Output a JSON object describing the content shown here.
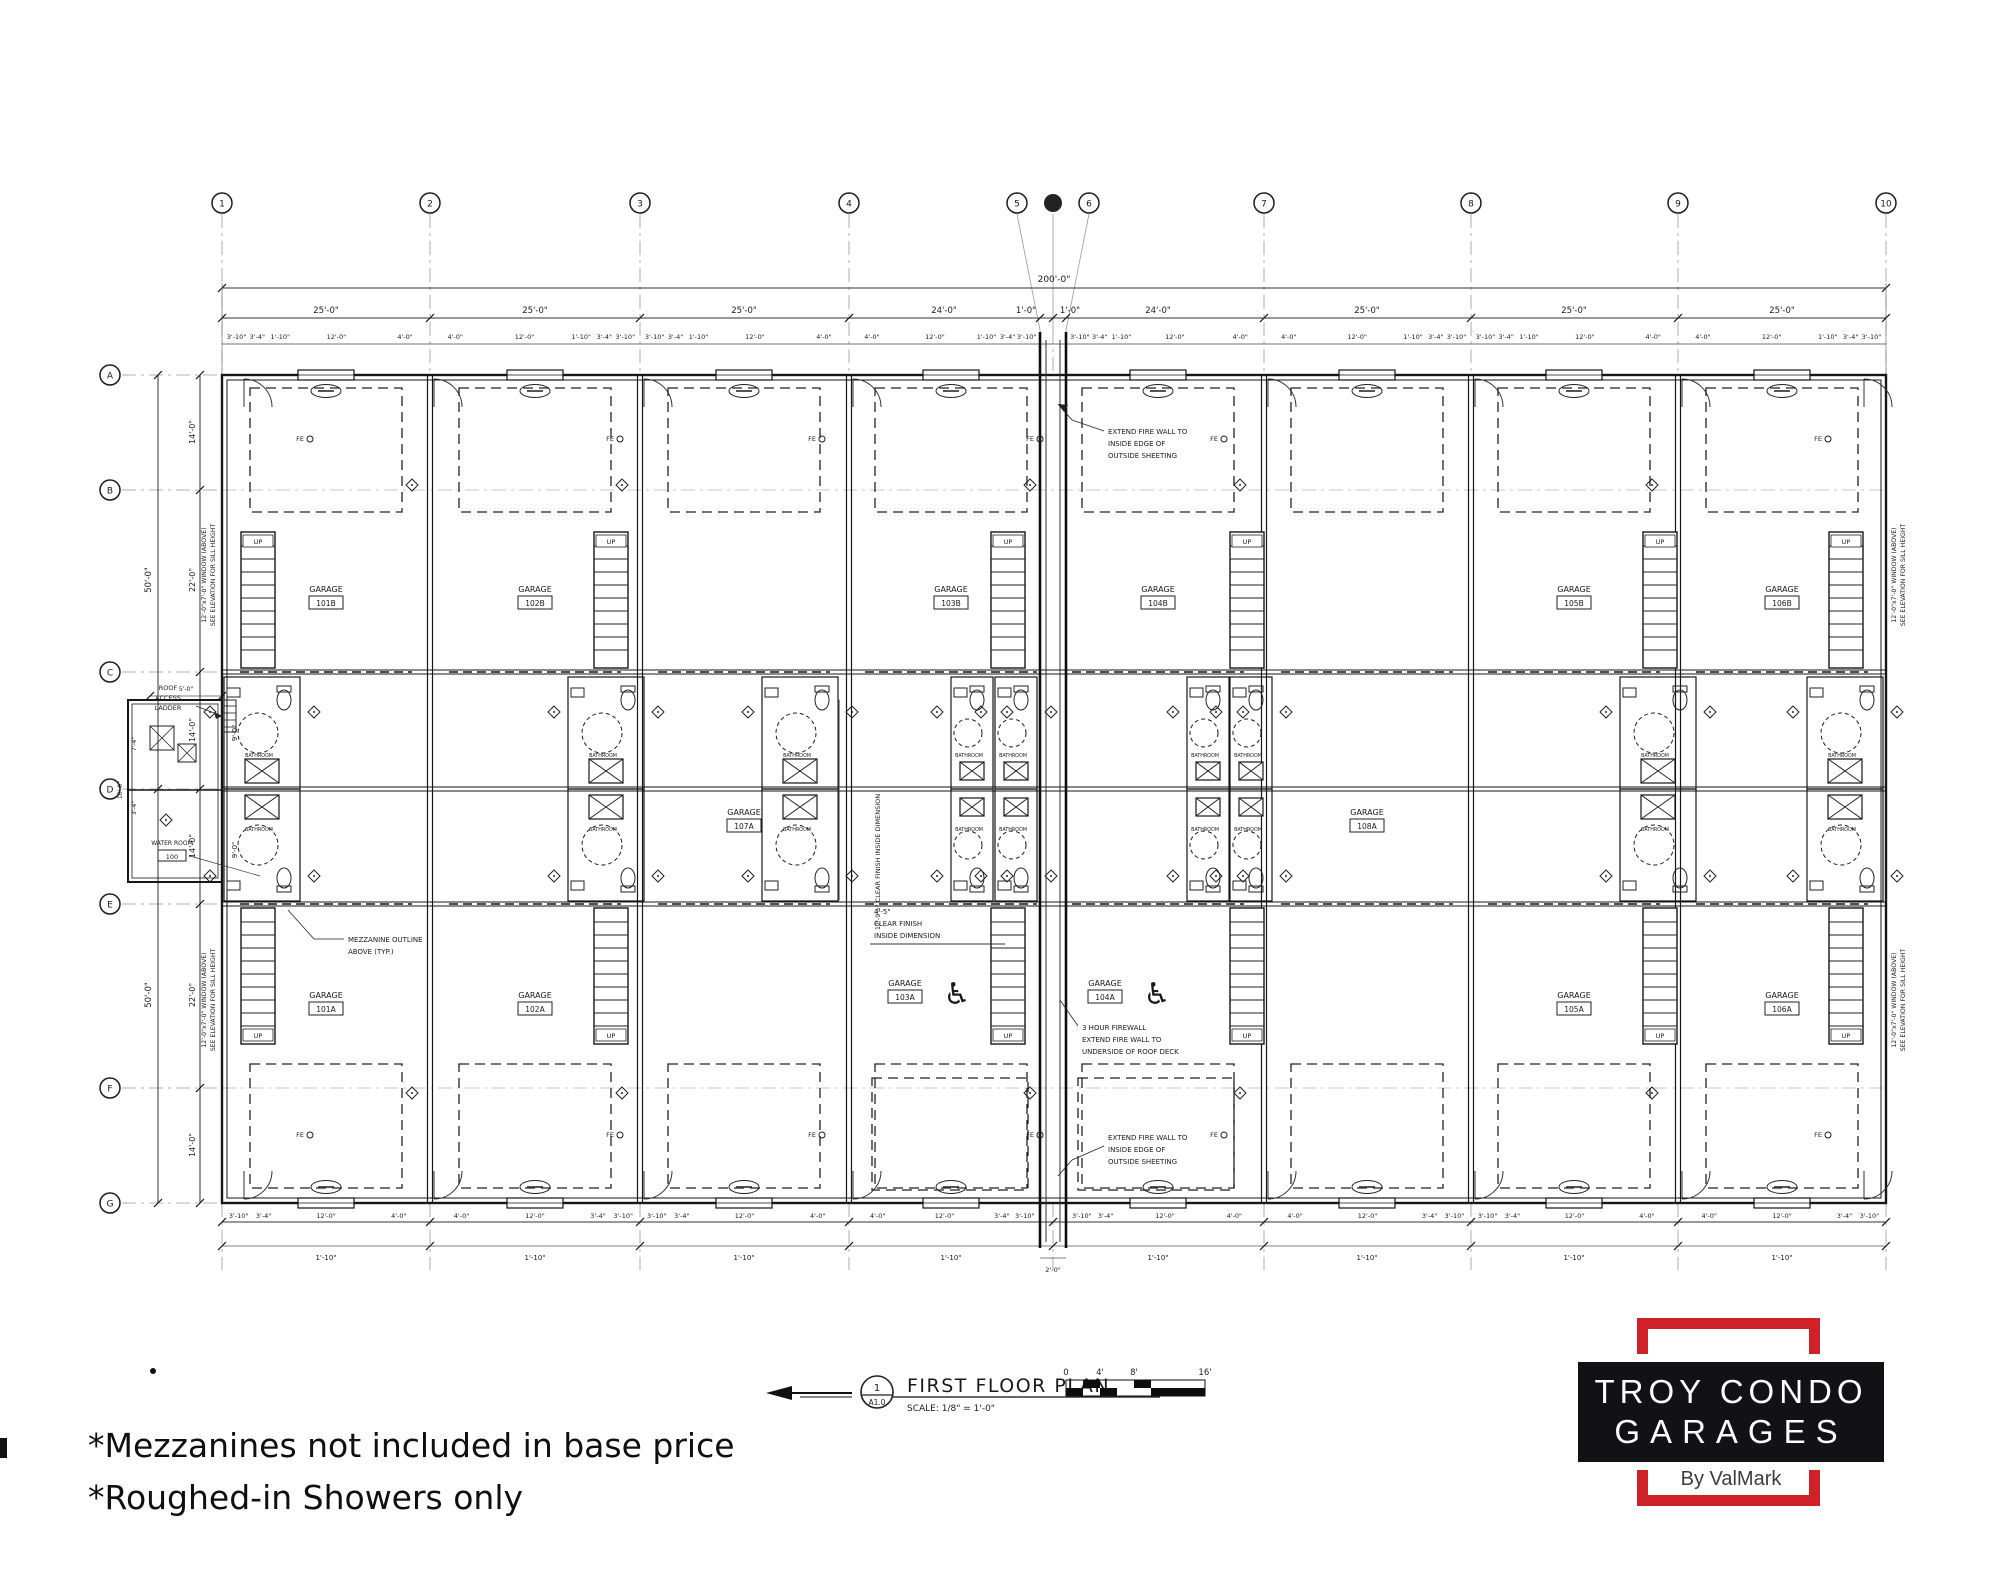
{
  "colors": {
    "line": "#1c1c1c",
    "grid": "#9a9a9a",
    "accent_red": "#d02128",
    "logo_black": "#121216"
  },
  "icons": {
    "wheelchair": "♿"
  },
  "footnotes": {
    "line1": "*Mezzanines not included in base price",
    "line2": "*Roughed-in Showers only"
  },
  "logo": {
    "line1": "TROY CONDO",
    "line2": "GARAGES",
    "byline": "By ValMark"
  },
  "titleblock": {
    "detail_number": "1",
    "sheet_ref": "A1.0",
    "title": "FIRST FLOOR PLAN",
    "scale": "SCALE: 1/8\" = 1'-0\"",
    "scale_ticks": [
      "0",
      "4'",
      "8'",
      "16'"
    ]
  },
  "grid": {
    "columns": [
      "1",
      "2",
      "3",
      "4",
      "5",
      "",
      "6",
      "7",
      "8",
      "9",
      "10"
    ],
    "rows": [
      "A",
      "B",
      "C",
      "D",
      "E",
      "F",
      "G"
    ]
  },
  "dims": {
    "overall_width": "200'-0\"",
    "bay_dims": [
      "25'-0\"",
      "25'-0\"",
      "25'-0\"",
      "24'-0\"",
      "1'-0\"",
      "1'-0\"",
      "24'-0\"",
      "25'-0\"",
      "25'-0\"",
      "25'-0\""
    ],
    "detail_top": [
      "3'-10\"",
      "3'-4\"",
      "1'-10\"",
      "12'-0\"",
      "4'-0\""
    ],
    "detail_bottom": [
      "3'-10\"",
      "3'-4\"",
      "12'-0\"",
      "4'-0\""
    ],
    "bottom_sub": "1'-10\"",
    "firewall_gap": "2'-0\"",
    "overall_height": "50'-0\"",
    "left_dims": [
      "14'-0\"",
      "22'-0\"",
      "14'-0\"",
      "14'-0\"",
      "22'-0\"",
      "14'-0\""
    ],
    "left_sub": "9'-0\"",
    "annex_top": "5'-0\"",
    "annex_side": "7'-4\"",
    "annex_side2": "3'-4\"",
    "annex_depth": "10'-0\""
  },
  "notes": {
    "fire_wall_edge": [
      "EXTEND FIRE WALL TO",
      "INSIDE EDGE OF",
      "OUTSIDE SHEETING"
    ],
    "firewall_3hr": [
      "3 HOUR FIREWALL",
      "EXTEND FIRE WALL TO",
      "UNDERSIDE OF ROOF DECK"
    ],
    "mezzanine": [
      "MEZZANINE OUTLINE",
      "ABOVE (TYP.)"
    ],
    "window": [
      "12'-0\"x7'-0\" WINDOW (ABOVE)",
      "SEE ELEVATION FOR SILL HEIGHT"
    ],
    "clear_vert": "12'-9½\" CLEAR FINISH INSIDE DIMENSION",
    "clear_horiz": [
      "4'-5\"",
      "CLEAR FINISH",
      "INSIDE DIMENSION"
    ],
    "roof_ladder": [
      "ROOF",
      "ACCESS",
      "LADDER"
    ],
    "up": "UP",
    "fe": "FE"
  },
  "rooms": {
    "garage_label": "GARAGE",
    "bathroom_label": "BATHROOM",
    "water_room": {
      "name": "WATER ROOM",
      "number": "100"
    },
    "garages_top": [
      "101B",
      "102B",
      "103B",
      "104B",
      "105B",
      "106B"
    ],
    "garages_mid": [
      "107A",
      "108A"
    ],
    "garages_bottom": [
      "101A",
      "102A",
      "105A",
      "106A"
    ],
    "garages_accessible": [
      "103A",
      "104A"
    ]
  }
}
